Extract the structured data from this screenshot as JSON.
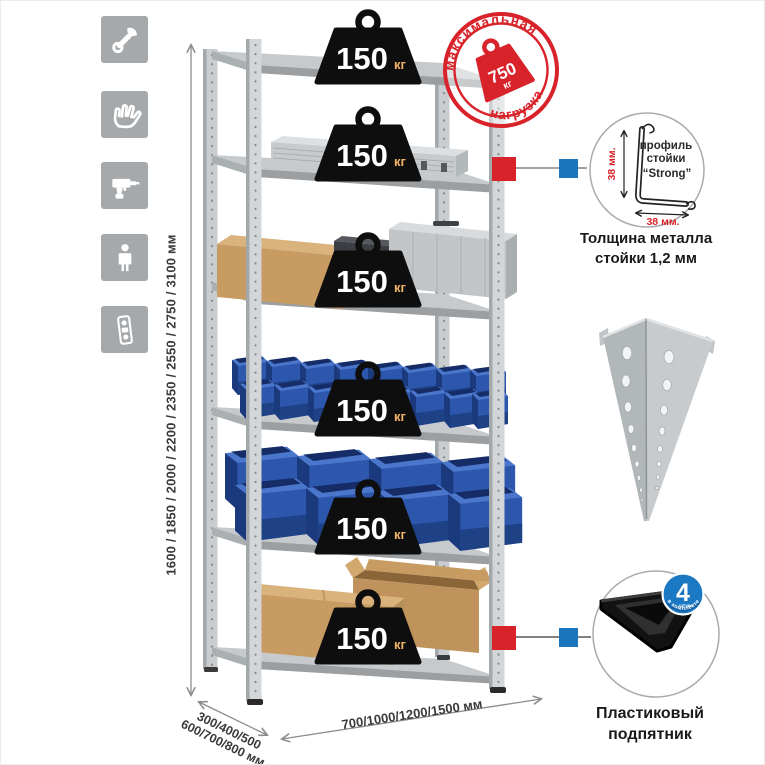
{
  "sidebar": {
    "icons": [
      {
        "name": "wrench-icon"
      },
      {
        "name": "gloves-icon"
      },
      {
        "name": "drill-icon"
      },
      {
        "name": "person-icon"
      },
      {
        "name": "level-icon"
      }
    ]
  },
  "dimensions": {
    "height": "1600 / 1850 / 2000 / 2200 / 2350 / 2550 / 2750 / 3100 мм",
    "depth_line1": "300/400/500",
    "depth_line2": "600/700/800 мм",
    "width": "700/1000/1200/1500 мм"
  },
  "stamp": {
    "arc_top": "максимальная",
    "arc_bottom": "нагрузка",
    "weight_value": "750",
    "weight_unit": "кг"
  },
  "shelves": {
    "weights": [
      {
        "value": "150",
        "unit": "кг"
      },
      {
        "value": "150",
        "unit": "кг"
      },
      {
        "value": "150",
        "unit": "кг"
      },
      {
        "value": "150",
        "unit": "кг"
      },
      {
        "value": "150",
        "unit": "кг"
      },
      {
        "value": "150",
        "unit": "кг"
      }
    ]
  },
  "profile_callout": {
    "label_line1": "профиль",
    "label_line2": "стойки",
    "label_line3": "“Strong”",
    "dim_vertical": "38 мм.",
    "dim_horizontal": "38 мм.",
    "caption_line1": "Толщина металла",
    "caption_line2": "стойки 1,2 мм"
  },
  "foot_callout": {
    "badge_value": "4",
    "badge_unit": "штуки",
    "badge_arc": "в комплекте",
    "caption_line1": "Пластиковый",
    "caption_line2": "подпятник"
  },
  "colors": {
    "accent_red": "#d8232a",
    "accent_blue": "#1b75bc",
    "icon_gray": "#a6a9ab",
    "bin_blue": "#2d57ad",
    "cardboard": "#c79b62",
    "metal_light": "#d6d9db",
    "metal_mid": "#b9bdc0"
  }
}
